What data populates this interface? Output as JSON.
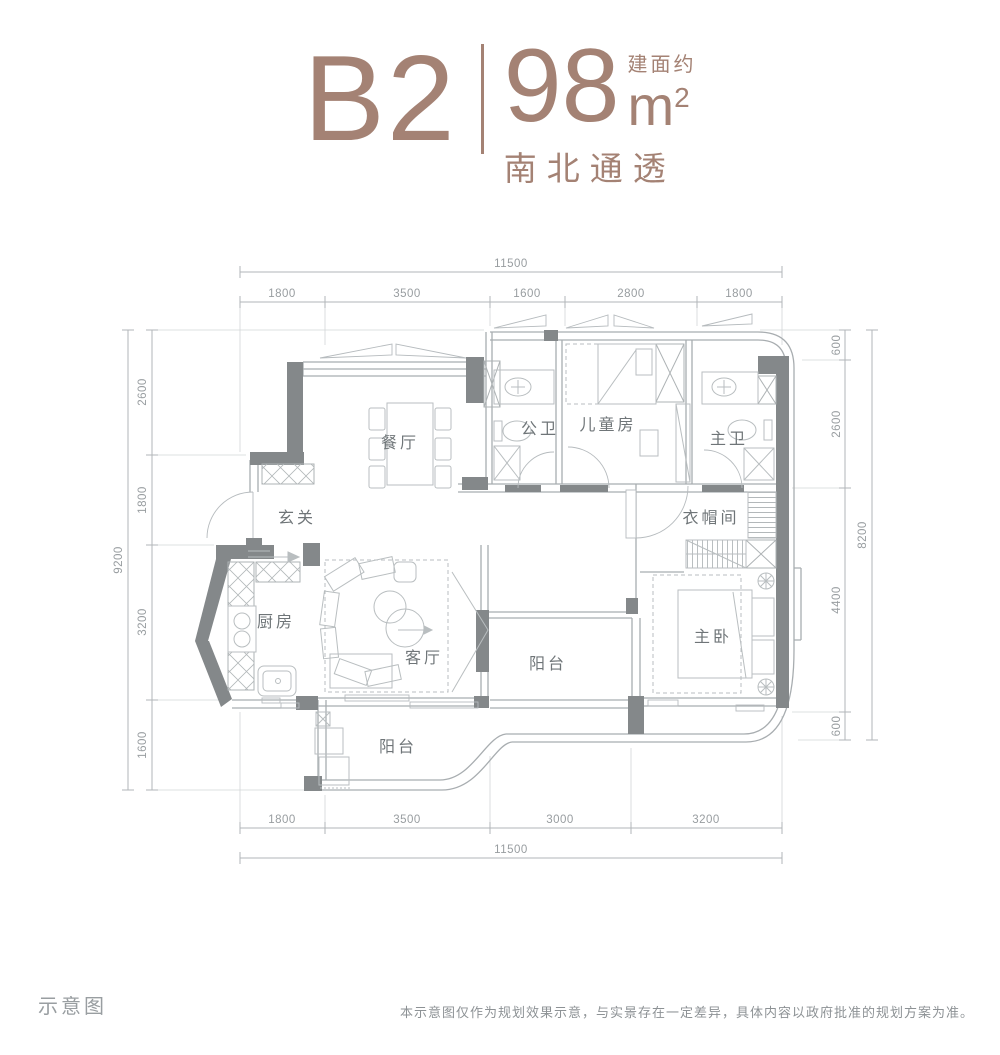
{
  "header": {
    "unit": "B2",
    "area_prefix": "建面约",
    "area_value": "98",
    "area_unit": "m",
    "area_exponent": "2",
    "subtitle": "南北通透",
    "accent_color": "#a48274"
  },
  "plan": {
    "rooms": {
      "dining": "餐厅",
      "entry": "玄关",
      "kitchen": "厨房",
      "living": "客厅",
      "balcony_south": "阳台",
      "balcony_center": "阳台",
      "bath_public": "公卫",
      "kids_room": "儿童房",
      "bath_master": "主卫",
      "cloakroom": "衣帽间",
      "master_bedroom": "主卧"
    }
  },
  "dimensions": {
    "top": {
      "total": "11500",
      "segments": [
        "1800",
        "3500",
        "1600",
        "2800",
        "1800"
      ]
    },
    "bottom": {
      "total": "11500",
      "segments": [
        "1800",
        "3500",
        "3000",
        "3200"
      ]
    },
    "left": {
      "total": "9200",
      "segments": [
        "2600",
        "1800",
        "3200",
        "1600"
      ]
    },
    "right": {
      "total": "8200",
      "segments": [
        "600",
        "2600",
        "4400",
        "600"
      ]
    }
  },
  "footer": {
    "caption": "示意图",
    "disclaimer": "本示意图仅作为规划效果示意，与实景存在一定差异，具体内容以政府批准的规划方案为准。"
  }
}
